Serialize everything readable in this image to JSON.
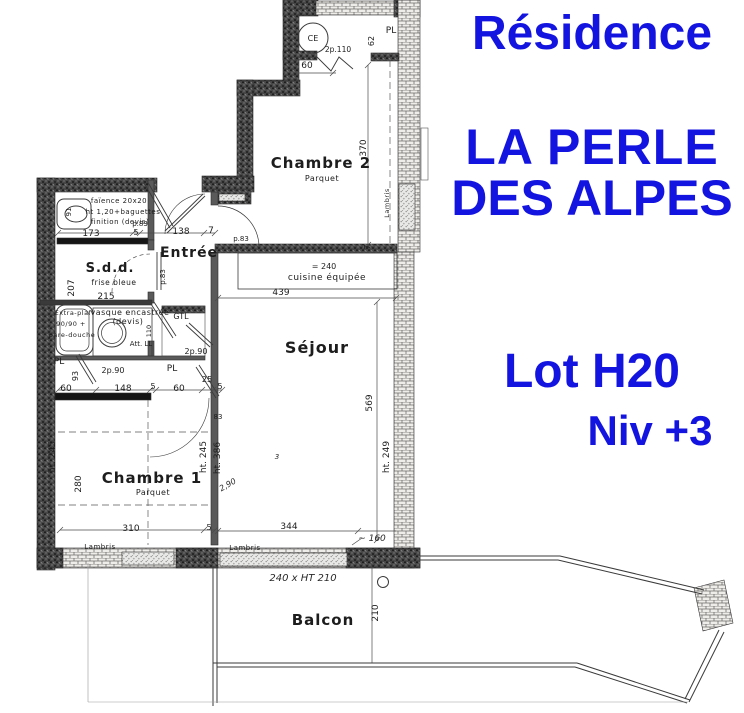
{
  "titles": {
    "residence": "Résidence",
    "name_line1": "LA PERLE",
    "name_line2": "DES ALPES",
    "lot": "Lot H20",
    "level": "Niv +3",
    "accent_color": "#1414e0"
  },
  "plan": {
    "labels": [
      {
        "n": "room-chambre-2",
        "t": "Chambre 2",
        "x": 321,
        "y": 168,
        "s": 15,
        "cls": "room"
      },
      {
        "n": "room-chambre-2-floor",
        "t": "Parquet",
        "x": 322,
        "y": 181,
        "s": 8,
        "cls": "sub"
      },
      {
        "n": "room-chambre-1",
        "t": "Chambre 1",
        "x": 152,
        "y": 483,
        "s": 15,
        "cls": "room"
      },
      {
        "n": "room-chambre-1-floor",
        "t": "Parquet",
        "x": 153,
        "y": 495,
        "s": 8,
        "cls": "sub"
      },
      {
        "n": "room-sejour",
        "t": "Séjour",
        "x": 317,
        "y": 353,
        "s": 16,
        "cls": "room"
      },
      {
        "n": "room-entree",
        "t": "Entrée",
        "x": 189,
        "y": 257,
        "s": 14,
        "cls": "room"
      },
      {
        "n": "room-sdd",
        "t": "S.d.d.",
        "x": 110,
        "y": 272,
        "s": 13,
        "cls": "room"
      },
      {
        "n": "room-sdd-note",
        "t": "frise bleue",
        "x": 114,
        "y": 285,
        "s": 7.5,
        "cls": "sub"
      },
      {
        "n": "room-balcon",
        "t": "Balcon",
        "x": 323,
        "y": 625,
        "s": 15,
        "cls": "room"
      },
      {
        "n": "kitchen-label",
        "t": "cuisine équipée",
        "x": 327,
        "y": 280,
        "s": 9,
        "cls": "sub"
      },
      {
        "n": "kitchen-length",
        "t": "= 240",
        "x": 324,
        "y": 269,
        "s": 8,
        "cls": "dim"
      },
      {
        "n": "dim-173",
        "t": "173",
        "x": 91,
        "y": 236,
        "s": 9,
        "cls": "dim"
      },
      {
        "n": "dim-5a",
        "t": "5",
        "x": 136,
        "y": 235,
        "s": 8,
        "cls": "dim"
      },
      {
        "n": "dim-138",
        "t": "138",
        "x": 181,
        "y": 234,
        "s": 9,
        "cls": "dim"
      },
      {
        "n": "dim-7a",
        "t": "7",
        "x": 211,
        "y": 233,
        "s": 9,
        "cls": "dim"
      },
      {
        "n": "door-p83-a",
        "t": "p.83",
        "x": 140,
        "y": 226,
        "s": 7,
        "cls": "dim"
      },
      {
        "n": "door-p83-b",
        "t": "p.83",
        "x": 241,
        "y": 241,
        "s": 7,
        "cls": "dim"
      },
      {
        "n": "dim-215",
        "t": "215",
        "x": 106,
        "y": 299,
        "s": 9,
        "cls": "dim"
      },
      {
        "n": "dim-310",
        "t": "310",
        "x": 131,
        "y": 531,
        "s": 9,
        "cls": "dim"
      },
      {
        "n": "dim-5b",
        "t": "5",
        "x": 209,
        "y": 530,
        "s": 8,
        "cls": "dim"
      },
      {
        "n": "dim-344",
        "t": "344",
        "x": 289,
        "y": 529,
        "s": 9,
        "cls": "dim"
      },
      {
        "n": "dim-439",
        "t": "439",
        "x": 281,
        "y": 295,
        "s": 9,
        "cls": "dim"
      },
      {
        "n": "dim-60a",
        "t": "60",
        "x": 66,
        "y": 391,
        "s": 9,
        "cls": "dim"
      },
      {
        "n": "dim-148",
        "t": "148",
        "x": 123,
        "y": 391,
        "s": 9,
        "cls": "dim"
      },
      {
        "n": "dim-5c",
        "t": "5",
        "x": 153,
        "y": 389,
        "s": 8,
        "cls": "dim"
      },
      {
        "n": "dim-60b",
        "t": "60",
        "x": 179,
        "y": 391,
        "s": 9,
        "cls": "dim"
      },
      {
        "n": "dim-25",
        "t": "25",
        "x": 207,
        "y": 382,
        "s": 8,
        "cls": "dim"
      },
      {
        "n": "dim-5d",
        "t": "5",
        "x": 220,
        "y": 389,
        "s": 8,
        "cls": "dim"
      },
      {
        "n": "dim-60c",
        "t": "60",
        "x": 307,
        "y": 68,
        "s": 9,
        "cls": "dim"
      },
      {
        "n": "closet-pl-ch2",
        "t": "PL",
        "x": 391,
        "y": 33,
        "s": 9,
        "cls": "dim"
      },
      {
        "n": "door-2p110",
        "t": "2p.110",
        "x": 338,
        "y": 52,
        "s": 7.5,
        "cls": "dim"
      },
      {
        "n": "fixture-ce",
        "t": "CE",
        "x": 313,
        "y": 41,
        "s": 8,
        "cls": "dim"
      },
      {
        "n": "closet-gtl",
        "t": "GTL",
        "x": 181,
        "y": 319,
        "s": 8,
        "cls": "dim"
      },
      {
        "n": "closet-pl-bath",
        "t": "PL",
        "x": 59,
        "y": 364,
        "s": 9,
        "cls": "dim"
      },
      {
        "n": "closet-pl-hall",
        "t": "PL",
        "x": 172,
        "y": 371,
        "s": 9,
        "cls": "dim"
      },
      {
        "n": "door-2p90-a",
        "t": "2p.90",
        "x": 113,
        "y": 373,
        "s": 8,
        "cls": "dim"
      },
      {
        "n": "door-2p90-b",
        "t": "2p.90",
        "x": 196,
        "y": 354,
        "s": 8,
        "cls": "dim"
      },
      {
        "n": "note-att-ll",
        "t": "Att. LL",
        "x": 141,
        "y": 346,
        "s": 7,
        "cls": "dim"
      },
      {
        "n": "note-lambris-a",
        "t": "Lambris",
        "x": 100,
        "y": 549,
        "s": 7,
        "cls": "sub"
      },
      {
        "n": "note-lambris-b",
        "t": "Lambris",
        "x": 245,
        "y": 550,
        "s": 7,
        "cls": "sub"
      },
      {
        "n": "note-extraplaf-1",
        "t": "Extra-plaf",
        "x": 73,
        "y": 315,
        "s": 6.5,
        "cls": "sub"
      },
      {
        "n": "note-extraplaf-2",
        "t": "90/90 +",
        "x": 71,
        "y": 326,
        "s": 6.5,
        "cls": "sub"
      },
      {
        "n": "note-extraplaf-3",
        "t": "pare-douche",
        "x": 72,
        "y": 337,
        "s": 6.5,
        "cls": "sub"
      },
      {
        "n": "note-vasque-1",
        "t": "vasque encastrée",
        "x": 130,
        "y": 315,
        "s": 8,
        "cls": "sub"
      },
      {
        "n": "note-vasque-2",
        "t": "(devis)",
        "x": 128,
        "y": 324,
        "s": 8,
        "cls": "sub"
      },
      {
        "n": "note-faience-1",
        "t": "faïence 20x20",
        "x": 119,
        "y": 203,
        "s": 7,
        "cls": "sub"
      },
      {
        "n": "note-faience-2",
        "t": "ht 1,20+baguettes",
        "x": 123,
        "y": 214,
        "s": 7,
        "cls": "sub"
      },
      {
        "n": "note-faience-3",
        "t": "finition (devis)",
        "x": 120,
        "y": 224,
        "s": 7,
        "cls": "sub"
      },
      {
        "n": "dim-83",
        "t": "83",
        "x": 218,
        "y": 419,
        "s": 7,
        "cls": "dim"
      },
      {
        "n": "mark-3",
        "t": "3",
        "x": 277,
        "y": 459,
        "s": 7,
        "cls": "hand"
      },
      {
        "n": "dim-7b",
        "t": "7",
        "x": 370,
        "y": 247,
        "s": 8,
        "cls": "dim",
        "r": -90
      },
      {
        "n": "dim-370",
        "t": "370",
        "x": 366,
        "y": 148,
        "s": 9,
        "cls": "dim",
        "r": -90
      },
      {
        "n": "dim-62",
        "t": "62",
        "x": 374,
        "y": 41,
        "s": 8,
        "cls": "dim",
        "r": -90
      },
      {
        "n": "dim-569",
        "t": "569",
        "x": 372,
        "y": 403,
        "s": 9,
        "cls": "dim",
        "r": -90
      },
      {
        "n": "dim-ht249",
        "t": "ht. 249",
        "x": 389,
        "y": 457,
        "s": 9,
        "cls": "dim",
        "r": -90
      },
      {
        "n": "dim-ht245-left",
        "t": "ht. 245",
        "x": 55,
        "y": 457,
        "s": 9,
        "cls": "dim",
        "r": -90
      },
      {
        "n": "dim-280",
        "t": "280",
        "x": 81,
        "y": 484,
        "s": 9,
        "cls": "dim",
        "r": -90
      },
      {
        "n": "dim-ht245-right",
        "t": "ht. 245",
        "x": 206,
        "y": 457,
        "s": 9,
        "cls": "dim",
        "r": -90
      },
      {
        "n": "dim-ht386",
        "t": "ht. 386",
        "x": 220,
        "y": 458,
        "s": 9,
        "cls": "dim",
        "r": -90
      },
      {
        "n": "dim-207",
        "t": "207",
        "x": 74,
        "y": 288,
        "s": 9,
        "cls": "dim",
        "r": -90
      },
      {
        "n": "dim-91",
        "t": "91",
        "x": 71,
        "y": 212,
        "s": 7,
        "cls": "dim",
        "r": -90
      },
      {
        "n": "dim-93",
        "t": "93",
        "x": 78,
        "y": 376,
        "s": 8,
        "cls": "dim",
        "r": -90
      },
      {
        "n": "dim-110",
        "t": "110",
        "x": 151,
        "y": 331,
        "s": 6.5,
        "cls": "dim",
        "r": -90
      },
      {
        "n": "note-lambris-wall",
        "t": "Lambris",
        "x": 389,
        "y": 203,
        "s": 6.5,
        "cls": "sub",
        "r": -90
      },
      {
        "n": "dim-210",
        "t": "210",
        "x": 378,
        "y": 613,
        "s": 9,
        "cls": "dim",
        "r": -90
      },
      {
        "n": "door-p83-sdd",
        "t": "p.83",
        "x": 165,
        "y": 277,
        "s": 7,
        "cls": "dim",
        "r": -90
      },
      {
        "n": "hand-window-note",
        "t": "240 x HT 210",
        "x": 303,
        "y": 581,
        "s": 10,
        "cls": "hand"
      },
      {
        "n": "hand-160",
        "t": "~ 160",
        "x": 372,
        "y": 541,
        "s": 9,
        "cls": "hand"
      },
      {
        "n": "hand-290",
        "t": "2,90",
        "x": 229,
        "y": 487,
        "s": 8,
        "cls": "hand",
        "r": -30
      }
    ]
  }
}
